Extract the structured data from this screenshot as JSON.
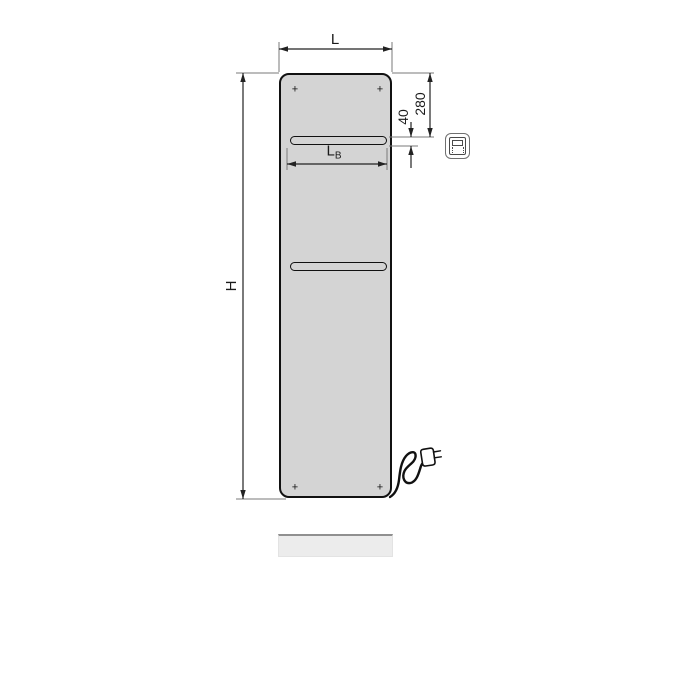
{
  "drawing": {
    "labels": {
      "width": "L",
      "height": "H",
      "top_offset": "280",
      "slot_height": "40",
      "slot_width_main": "L",
      "slot_width_sub": "B"
    },
    "screw_mark": "+",
    "icon": "electric-radiator-pictogram",
    "colors": {
      "panel_fill": "#d4d4d4",
      "outline": "#111111",
      "dimension_line": "#222222",
      "extension_line": "#7a7a7a",
      "shadow_fill": "#ececec",
      "shadow_edge": "#909090",
      "text_color": "#1a1a1a"
    }
  }
}
